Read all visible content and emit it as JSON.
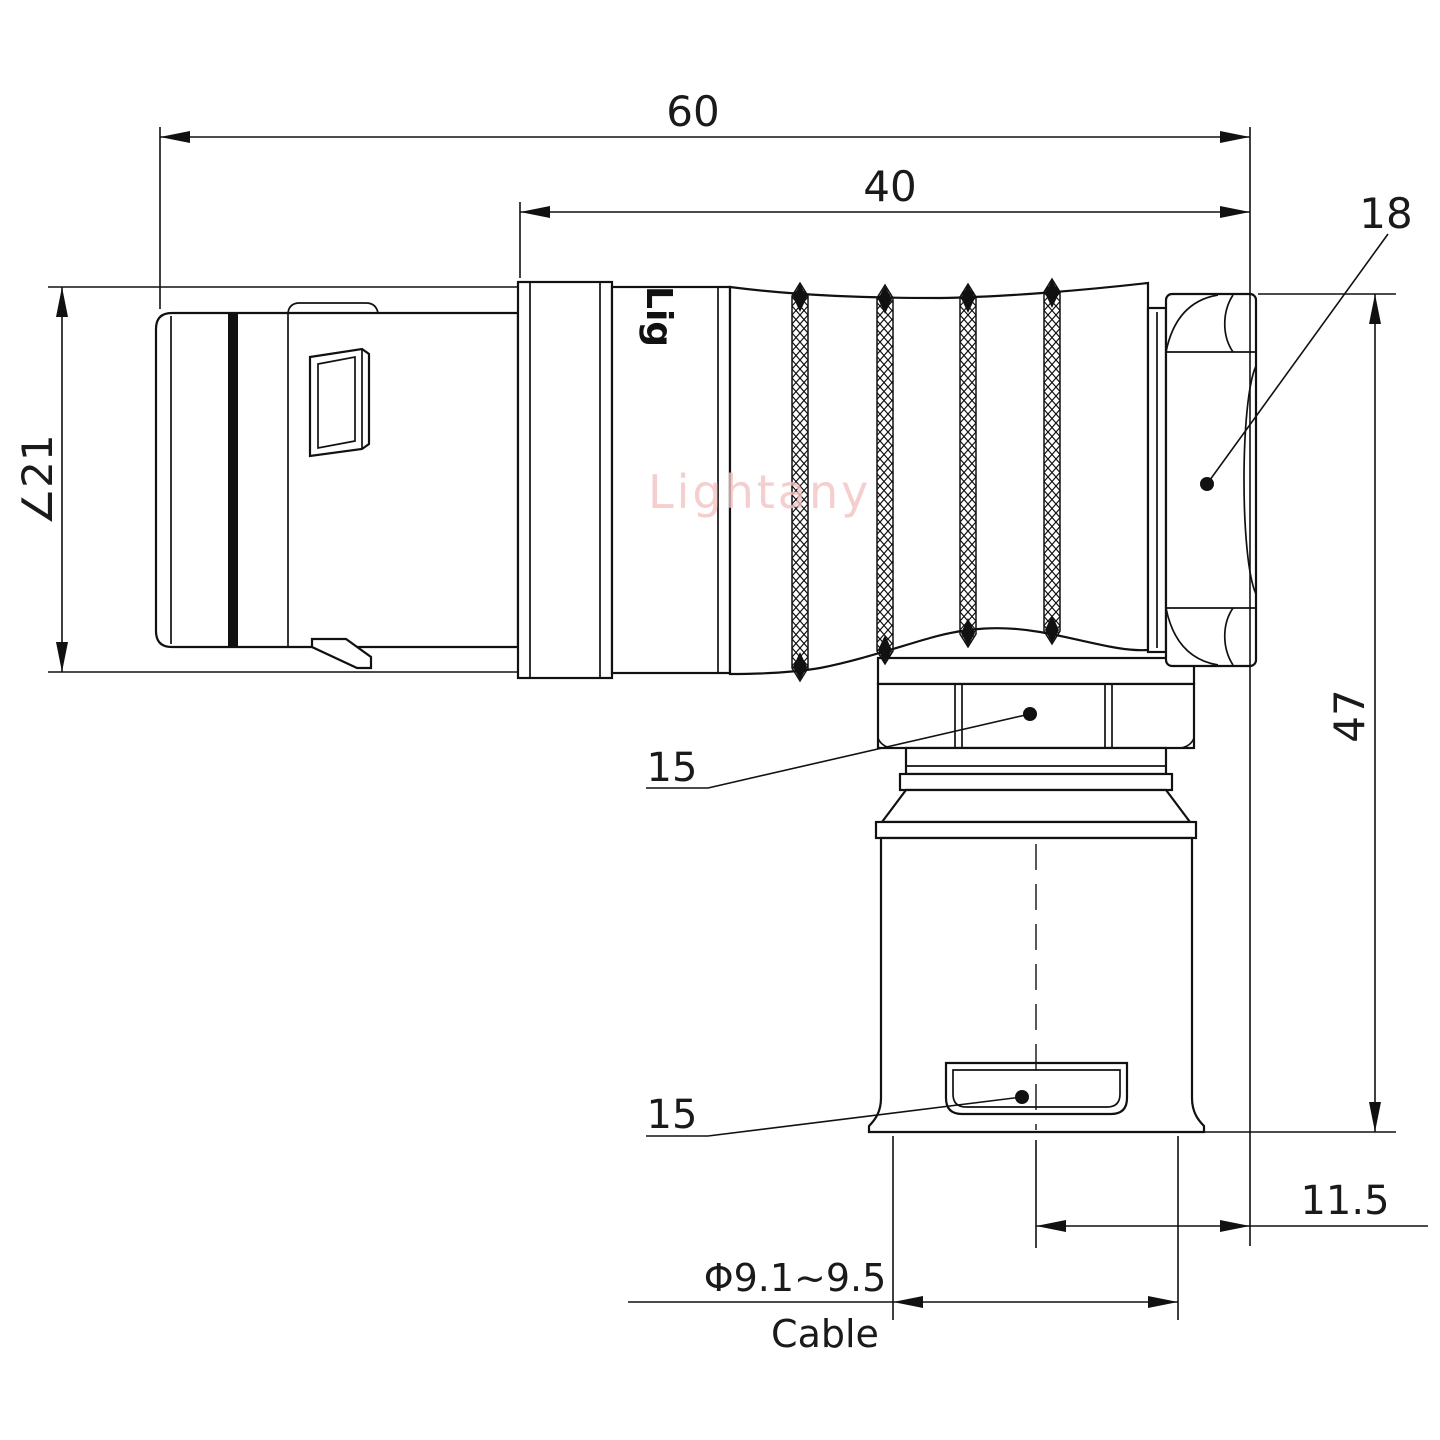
{
  "drawing": {
    "watermark": "Lightany",
    "engraving": "Lig",
    "dimensions": {
      "overall_length": "60",
      "rear_length": "40",
      "coupling_nut_size": "18",
      "sleeve_diameter": "∠21",
      "overall_height": "47",
      "elbow_nut_size": "15",
      "cable_clamp_size": "15",
      "axis_offset": "11.5",
      "cable_diameter": "Φ9.1~9.5",
      "cable_label": "Cable"
    }
  }
}
